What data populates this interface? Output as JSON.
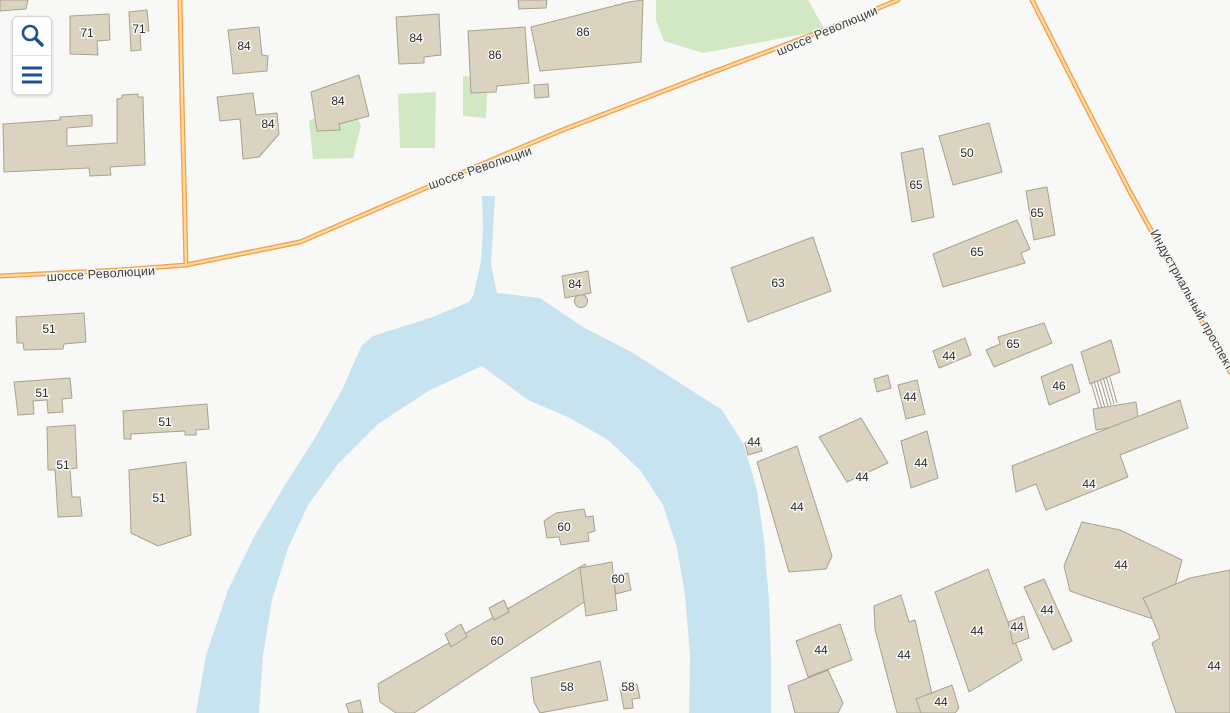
{
  "app": {
    "type": "map-viewer"
  },
  "controls": {
    "search_button": {
      "icon": "search-icon"
    },
    "menu_button": {
      "icon": "menu-icon"
    }
  },
  "streets": [
    {
      "name": "шоссе Революции"
    },
    {
      "name": "Индустриальный проспект"
    }
  ],
  "map": {
    "background": "#f8f8f6",
    "colors": {
      "building_fill": "#d9d3c0",
      "building_stroke": "#a9a28f",
      "river": "#c8e3f0",
      "green": "#d2e7c4",
      "road_casing": "#f0a14c",
      "road_fill": "#fdd9a1",
      "number_label": "#2b2b2b",
      "street_label": "#3c3c3c",
      "label_halo": "#f8f8f6",
      "icon_blue": "#1a5292",
      "bridge_line": "#a49d8c"
    },
    "greens": [
      "656,0 808,0 825,30 703,53 664,41 656,20",
      "463,76 488,78 486,118 463,116",
      "398,94 436,92 435,148 400,148",
      "309,121 350,100 361,126 353,158 313,159"
    ],
    "river": "196,713 206,655 228,590 255,535 285,485 315,438 342,390 362,345 373,336 430,318 469,302 473,296 481,262 483,228 482,196 495,196 493,230 491,264 497,293 540,298 583,327 633,353 680,383 722,410 744,445 757,490 764,540 769,600 771,660 771,713 689,713 690,655 685,595 677,548 663,505 640,470 608,440 570,418 528,400 482,366 430,390 378,424 338,464 308,505 288,548 272,600 263,655 259,713",
    "roads": [
      {
        "name": "шоссе Революции",
        "points": "0,276 120,270 186,265 300,242 428,187 560,131 700,77 830,28 898,0"
      },
      {
        "name": "подъезд",
        "points": "180,0 182,100 184,180 186,265"
      },
      {
        "name": "Индустриальный проспект",
        "points": "1032,0 1080,95 1129,190 1180,283 1230,372"
      }
    ],
    "street_labels": [
      {
        "text": "шоссе Революции",
        "x": 101,
        "y": 274,
        "rotate": -3.5
      },
      {
        "text": "шоссе Революции",
        "x": 480,
        "y": 168,
        "rotate": -19
      },
      {
        "text": "шоссе Революции",
        "x": 827,
        "y": 31,
        "rotate": -23
      },
      {
        "text": "Индустриальный проспект",
        "x": 1192,
        "y": 300,
        "rotate": 61
      }
    ],
    "buildings": [
      {
        "p": "70,16 109,14 110,40 97,41 98,55 70,54",
        "l": "71",
        "x": 87,
        "y": 33
      },
      {
        "p": "129,12 147,10 149,31 140,31 141,50 131,51",
        "l": "71",
        "x": 139,
        "y": 29
      },
      {
        "p": "228,30 259,27 262,55 268,56 267,71 233,74 231,55",
        "l": "84",
        "x": 244,
        "y": 46
      },
      {
        "p": "396,17 439,14 441,55 424,57 424,63 399,64",
        "l": "84",
        "x": 416,
        "y": 38
      },
      {
        "p": "468,31 525,27 529,83 497,86 496,92 471,93",
        "l": "86",
        "x": 495,
        "y": 55
      },
      {
        "p": "531,27 629,2 643,0 641,62 540,71",
        "l": "86",
        "x": 583,
        "y": 32
      },
      {
        "p": "534,85 548,84 549,97 535,98"
      },
      {
        "p": "518,0 547,0 546,8 519,9"
      },
      {
        "p": "0,0 28,0 26,9 0,11"
      },
      {
        "p": "311,92 359,75 369,116 339,124 340,130 317,131",
        "l": "84",
        "x": 338,
        "y": 101
      },
      {
        "p": "217,97 253,93 256,115 277,113 279,134 259,157 243,159 240,119 220,121",
        "l": "84",
        "x": 268,
        "y": 124
      },
      {
        "p": "3,124 60,120 60,117 92,115 92,126 67,128 67,146 117,143 117,99 122,98 122,95 138,94 138,97 143,97 145,165 110,167 111,175 90,176 89,168 4,172"
      },
      {
        "p": "939,136 989,123 1002,172 953,185",
        "l": "50",
        "x": 967,
        "y": 153
      },
      {
        "p": "901,153 923,148 934,217 912,222",
        "l": "65",
        "x": 916,
        "y": 185
      },
      {
        "p": "1026,191 1047,187 1055,235 1034,240",
        "l": "65",
        "x": 1037,
        "y": 213
      },
      {
        "p": "933,254 1017,220 1030,249 1021,253 1025,263 943,287",
        "l": "65",
        "x": 977,
        "y": 252
      },
      {
        "p": "731,268 813,237 831,291 748,322",
        "l": "63",
        "x": 778,
        "y": 283
      },
      {
        "p": "986,350 1000,344 998,337 1044,323 1052,343 994,367",
        "l": "65",
        "x": 1013,
        "y": 344
      },
      {
        "p": "933,351 965,338 971,355 939,368",
        "l": "44",
        "x": 949,
        "y": 356
      },
      {
        "p": "1041,377 1072,364 1080,392 1049,405",
        "l": "46",
        "x": 1059,
        "y": 386
      },
      {
        "p": "1081,352 1111,340 1120,372 1090,384"
      },
      {
        "p": "1093,409 1136,402 1139,423 1096,430"
      },
      {
        "p": "874,379 888,375 891,388 877,392"
      },
      {
        "p": "898,385 917,380 925,414 906,419",
        "l": "44",
        "x": 910,
        "y": 397
      },
      {
        "p": "745,443 759,439 762,451 748,455",
        "l": "44",
        "x": 754,
        "y": 442
      },
      {
        "p": "757,462 797,446 832,556 826,569 789,572",
        "l": "44",
        "x": 797,
        "y": 507
      },
      {
        "p": "819,437 861,418 888,463 847,482",
        "l": "44",
        "x": 862,
        "y": 477
      },
      {
        "p": "901,441 927,431 938,478 911,488",
        "l": "44",
        "x": 921,
        "y": 463
      },
      {
        "p": "1012,466 1180,400 1188,428 1120,455 1128,477 1046,510 1036,484 1016,492",
        "l": "44",
        "x": 1089,
        "y": 484
      },
      {
        "p": "1064,566 1082,522 1120,530 1182,560 1165,623 1087,597 1070,591",
        "l": "44",
        "x": 1121,
        "y": 565
      },
      {
        "p": "1143,598 1190,578 1230,570 1230,713 1176,713 1152,643 1160,638 1148,608",
        "l": "44",
        "x": 1214,
        "y": 666
      },
      {
        "p": "796,641 840,624 852,660 808,677",
        "l": "44",
        "x": 821,
        "y": 650
      },
      {
        "p": "874,606 901,595 909,622 915,620 934,703 921,713 897,713 875,629",
        "l": "44",
        "x": 904,
        "y": 655
      },
      {
        "p": "935,592 988,569 1022,660 969,692",
        "l": "44",
        "x": 977,
        "y": 631
      },
      {
        "p": "1008,622 1024,616 1029,638 1013,644",
        "l": "44",
        "x": 1017,
        "y": 627
      },
      {
        "p": "1024,587 1044,579 1072,641 1053,650",
        "l": "44",
        "x": 1047,
        "y": 610
      },
      {
        "p": "916,699 952,685 959,708 955,713 921,713",
        "l": "44",
        "x": 941,
        "y": 702
      },
      {
        "p": "788,686 828,670 843,703 838,713 795,713"
      },
      {
        "p": "531,678 600,661 608,700 540,713 534,702",
        "l": "58",
        "x": 567,
        "y": 687
      },
      {
        "p": "620,688 637,684 640,698 632,699 633,708 624,709",
        "l": "58",
        "x": 628,
        "y": 687
      },
      {
        "p": "544,521 556,513 584,509 586,517 593,516 595,531 588,533 589,541 561,545 559,537 547,538",
        "l": "60",
        "x": 564,
        "y": 527
      },
      {
        "p": "613,577 628,573 631,590 616,594",
        "l": "60",
        "x": 618,
        "y": 579
      },
      {
        "p": "378,684 585,564 601,591 414,713 396,713 380,702",
        "l": "60",
        "x": 497,
        "y": 641
      },
      {
        "p": "580,568 612,562 617,610 586,616"
      },
      {
        "p": "445,634 461,624 467,637 451,647"
      },
      {
        "p": "489,608 504,600 509,612 494,620"
      },
      {
        "p": "16,317 84,313 86,342 64,344 63,349 24,350 23,343 17,343",
        "l": "51",
        "x": 49,
        "y": 329
      },
      {
        "p": "14,382 70,378 72,398 62,399 63,412 48,413 47,400 33,401 34,414 18,415",
        "l": "51",
        "x": 42,
        "y": 393
      },
      {
        "p": "123,411 207,404 209,429 196,430 196,435 185,435 185,431 131,434 131,439 124,439",
        "l": "51",
        "x": 165,
        "y": 422
      },
      {
        "p": "47,427 75,425 77,468 70,469 72,497 80,497 82,516 58,517 55,470 48,470",
        "l": "51",
        "x": 63,
        "y": 465
      },
      {
        "p": "129,470 186,462 191,535 158,546 131,533",
        "l": "51",
        "x": 159,
        "y": 498
      },
      {
        "p": "562,276 588,271 591,293 565,298",
        "l": "84",
        "x": 575,
        "y": 284
      },
      {
        "p": "346,704 360,700 363,713 349,713"
      }
    ],
    "footbridge": [
      [
        1091,
        382,
        1099,
        410
      ],
      [
        1094,
        381,
        1102,
        409
      ],
      [
        1097,
        380,
        1105,
        408
      ],
      [
        1100,
        378,
        1108,
        406
      ],
      [
        1103,
        377,
        1111,
        405
      ],
      [
        1106,
        376,
        1114,
        404
      ],
      [
        1109,
        374,
        1117,
        403
      ]
    ],
    "tower": {
      "cx": 581,
      "cy": 301,
      "r": 6.5,
      "x1": 575,
      "y1": 293,
      "x2": 580,
      "y2": 298
    }
  }
}
